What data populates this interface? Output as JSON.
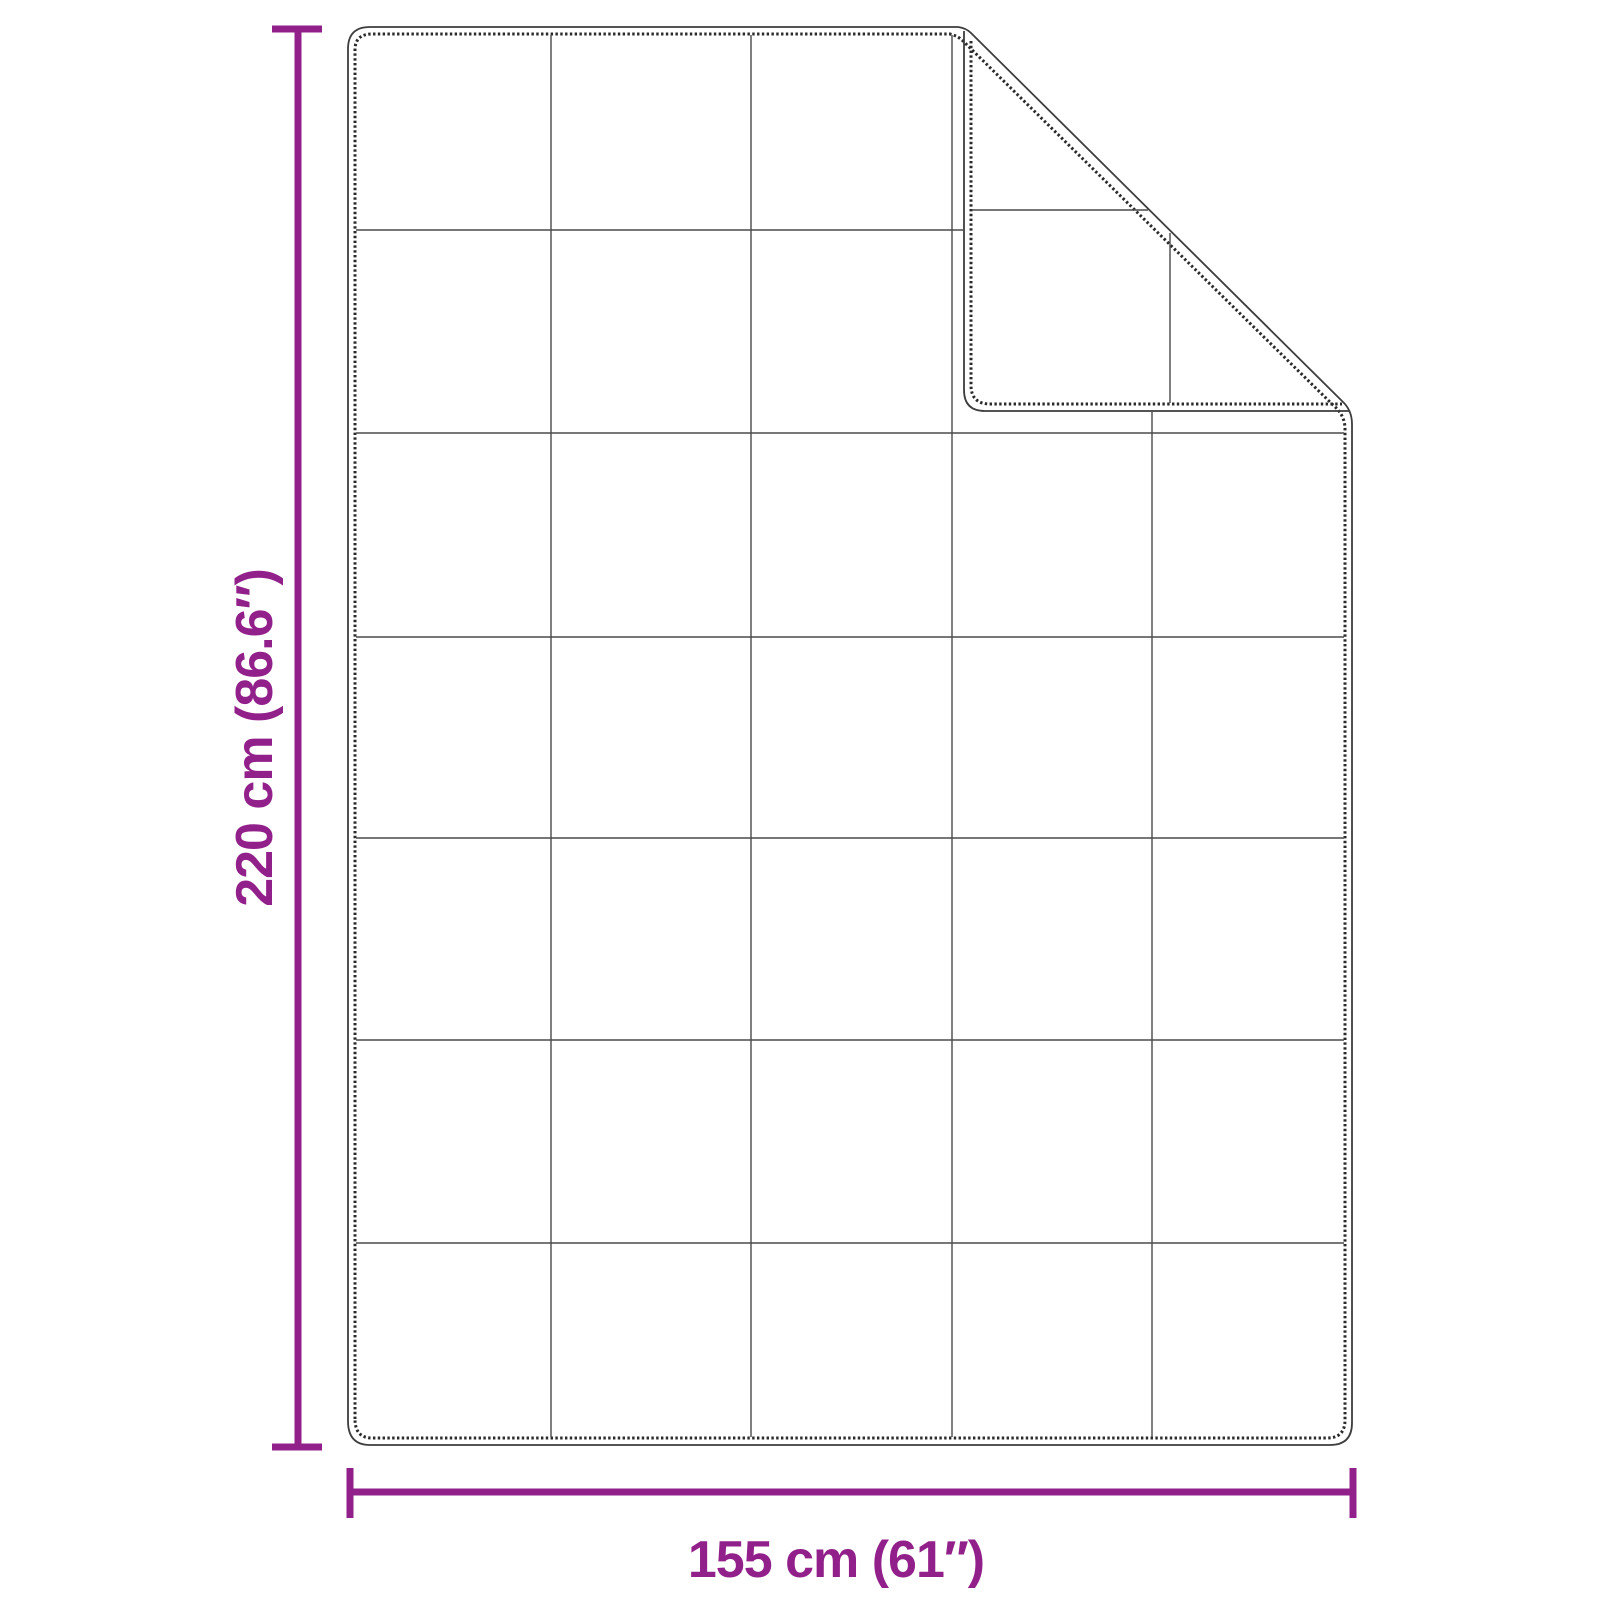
{
  "colors": {
    "accent": "#92208A",
    "outline": "#3d3d3d",
    "stitch": "#2a2a2a",
    "grid_line": "#4a4a4a",
    "background": "#ffffff"
  },
  "diagram": {
    "kind": "blanket-dimension-diagram",
    "dimensions": {
      "height_label": "220 cm (86.6″)",
      "width_label": "155 cm (61″)"
    },
    "blanket": {
      "grid_columns": 5,
      "grid_rows": 7,
      "folded_corner": "top-right"
    }
  }
}
